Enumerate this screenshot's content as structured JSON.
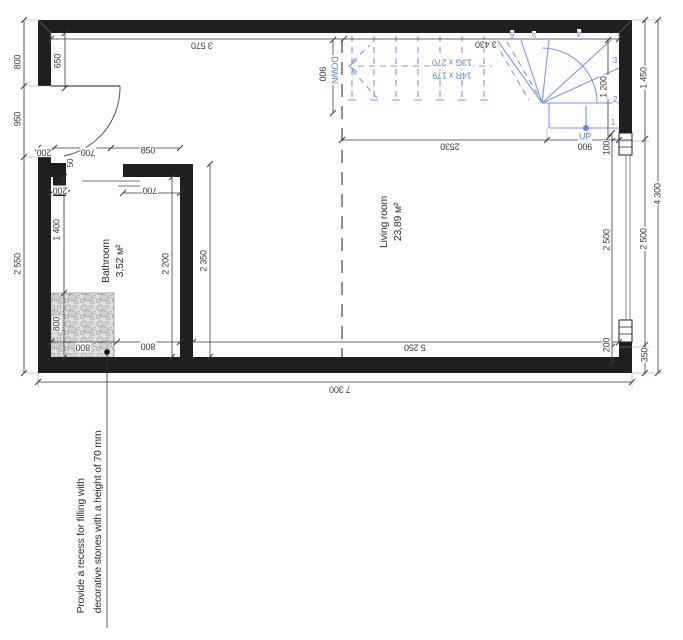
{
  "drawing_title": "Floor plan",
  "colors": {
    "wall": "#1f1f1f",
    "stair_blue": "#7b97ea",
    "stair_blue_text": "#5d84ee",
    "dim_text": "#3a3a3a",
    "stone_fill": "#e0e0e0"
  },
  "rooms": {
    "bathroom": {
      "name": "Bathroom",
      "area": "3,52 м²"
    },
    "living": {
      "name": "Living room",
      "area": "23,89 м²"
    }
  },
  "stair": {
    "down_label": "DOWN",
    "up_label": "UP",
    "spec_goings": "13G x 270",
    "spec_risers": "14R x 179",
    "steps": [
      "1",
      "2",
      "3",
      "4",
      "5",
      "6"
    ]
  },
  "note": {
    "line1": "Provide a recess for filling with",
    "line2": "decorative stones with a height of 70 mm"
  },
  "dimensions": {
    "left_800": "800",
    "left_950": "950",
    "left_2550": "2 550",
    "left_650": "650",
    "top_3570": "3 570",
    "top_3430": "3 430",
    "top_200": "200",
    "top_700": "700",
    "top_850": "850",
    "in_200": "200",
    "in_700": "700",
    "bath_50": "50",
    "bath_1400": "1 400",
    "bath_800v": "800",
    "bath_2200": "2 200",
    "bath_2350": "2 350",
    "stair_900v": "900",
    "stair_2530": "2530",
    "stair_900h": "900",
    "stair_1200": "1 200",
    "right_100": "100",
    "right_2500a": "2 500",
    "right_200": "200",
    "right_1450": "1 450",
    "right_2500b": "2 500",
    "right_350": "350",
    "right_4300": "4 300",
    "bottom_800a": "800",
    "bottom_800b": "800",
    "bottom_5250": "5 250",
    "bottom_7300": "7 300"
  }
}
